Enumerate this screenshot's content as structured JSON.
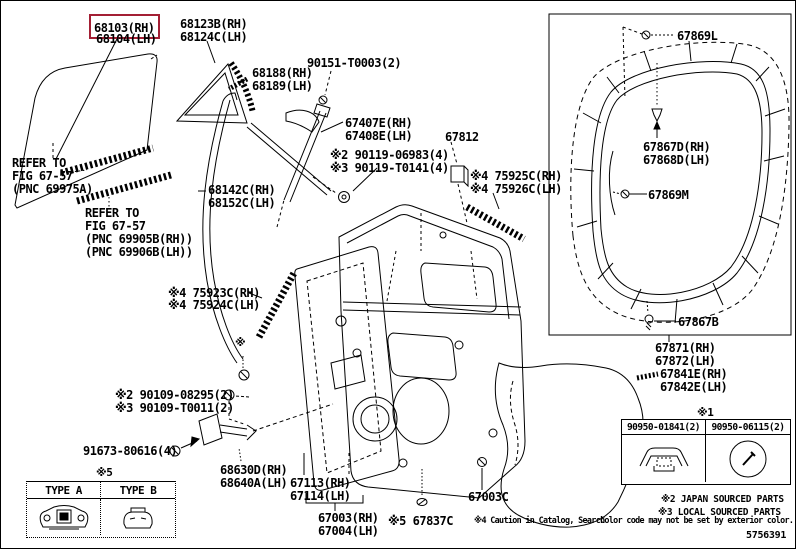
{
  "colors": {
    "accent_red": "#a31f34",
    "line": "#000000",
    "background": "#ffffff"
  },
  "labels": {
    "glass_rh": "68103(RH)",
    "glass_lh": "68104(LH)",
    "qtr_glass_rh": "68123B(RH)",
    "qtr_glass_lh": "68124C(LH)",
    "qtr_ws_rh": "68188(RH)",
    "qtr_ws_lh": "68189(LH)",
    "screw_90151": "90151-T0003(2)",
    "frame_rh": "67407E(RH)",
    "frame_lh": "67408E(LH)",
    "part_67812": "67812",
    "screw_90119a": "※2 90119-06983(4)",
    "screw_90119b": "※3 90119-T0141(4)",
    "tape_rr_rh": "※4 75925C(RH)",
    "tape_rr_lh": "※4 75926C(LH)",
    "refer1_l1": "REFER TO",
    "refer1_l2": "FIG 67-57",
    "refer1_l3": "(PNC 69975A)",
    "run_rh": "68142C(RH)",
    "run_lh": "68152C(LH)",
    "refer2_l1": "REFER TO",
    "refer2_l2": "FIG 67-57",
    "refer2_l3": "(PNC 69905B(RH))",
    "refer2_l4": "(PNC 69906B(LH))",
    "tape_fr_rh": "※4 75923C(RH)",
    "tape_fr_lh": "※4 75924C(LH)",
    "asterisk": "※",
    "screw_90109a": "※2 90109-08295(2)",
    "screw_90109b": "※3 90109-T0011(2)",
    "bolt_91673": "91673-80616(4)",
    "check_rh": "68630D(RH)",
    "check_lh": "68640A(LH)",
    "panel_rh": "67113(RH)",
    "panel_lh": "67114(LH)",
    "door_rh": "67003(RH)",
    "door_lh": "67004(LH)",
    "clip_67837": "※5 67837C",
    "grommet_67003c": "67003C",
    "ws_screw_l": "67869L",
    "ws_clip_rh": "67867D(RH)",
    "ws_clip_lh": "67868D(LH)",
    "ws_clip_m": "67869M",
    "ws_screw_b": "67867B",
    "ws_rh": "67871(RH)",
    "ws_lh": "67872(LH)",
    "shield_rh": "67841E(RH)",
    "shield_lh": "67842E(LH)"
  },
  "tables": {
    "door_check": {
      "title": "※5",
      "col_a": "TYPE A",
      "col_b": "TYPE B"
    },
    "grommets": {
      "title": "※1",
      "col_a": "90950-01841(2)",
      "col_b": "90950-06115(2)"
    }
  },
  "notes": {
    "japan": "※2 JAPAN SOURCED PARTS",
    "local": "※3 LOCAL SOURCED PARTS",
    "caution": "※4 Caution in Catalog, Search",
    "color": "Color code may not be set by exterior color.",
    "figure_code": "5756391"
  }
}
